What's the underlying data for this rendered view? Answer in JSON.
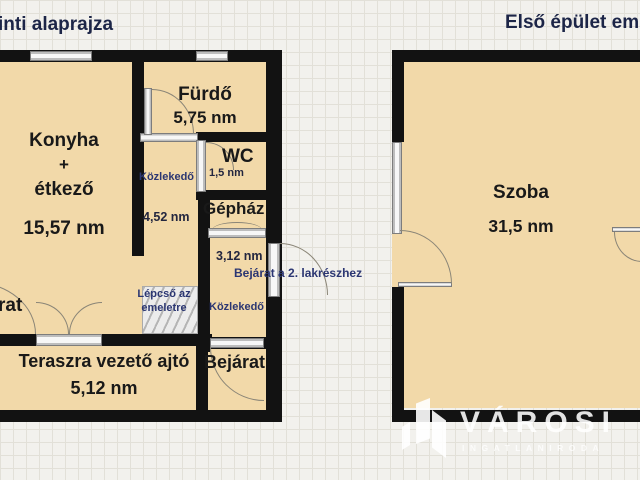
{
  "titles": {
    "left_partial": "inti alaprajza",
    "right_partial": "Első épület em"
  },
  "left_plan": {
    "rooms": {
      "konyha": {
        "l1": "Konyha",
        "l2": "+",
        "l3": "étkező",
        "area": "15,57 nm"
      },
      "furdo": {
        "name": "Fürdő",
        "area": "5,75 nm"
      },
      "wc": {
        "name": "WC",
        "area": "1,5 nm"
      },
      "kozlekedo_upper": {
        "name": "Közlekedő",
        "area": "4,52 nm"
      },
      "gephaz": {
        "name": "Gépház"
      },
      "kozlekedo_lower": {
        "name": "Közlekedő",
        "area": "3,12 nm"
      },
      "lepcso": {
        "line1": "Lépcső az",
        "line2": "emeletre"
      },
      "terasz": {
        "name": "Teraszra vezető ajtó",
        "area": "5,12 nm"
      },
      "bejarat": {
        "name": "Bejárat"
      },
      "cut_label": "rat"
    },
    "annotations": {
      "bejarat2": "Bejárat a 2. lakrészhez"
    }
  },
  "right_plan": {
    "szoba": {
      "name": "Szoba",
      "area": "31,5 nm"
    }
  },
  "watermark": {
    "brand": "VÁROSI",
    "sub": "INGATLANIRODA"
  },
  "colors": {
    "floor": "#f2d9a9",
    "wall": "#121212",
    "label_navy": "#2b3672",
    "title_navy": "#1c2547",
    "grid_bg": "#f2f1ed"
  }
}
